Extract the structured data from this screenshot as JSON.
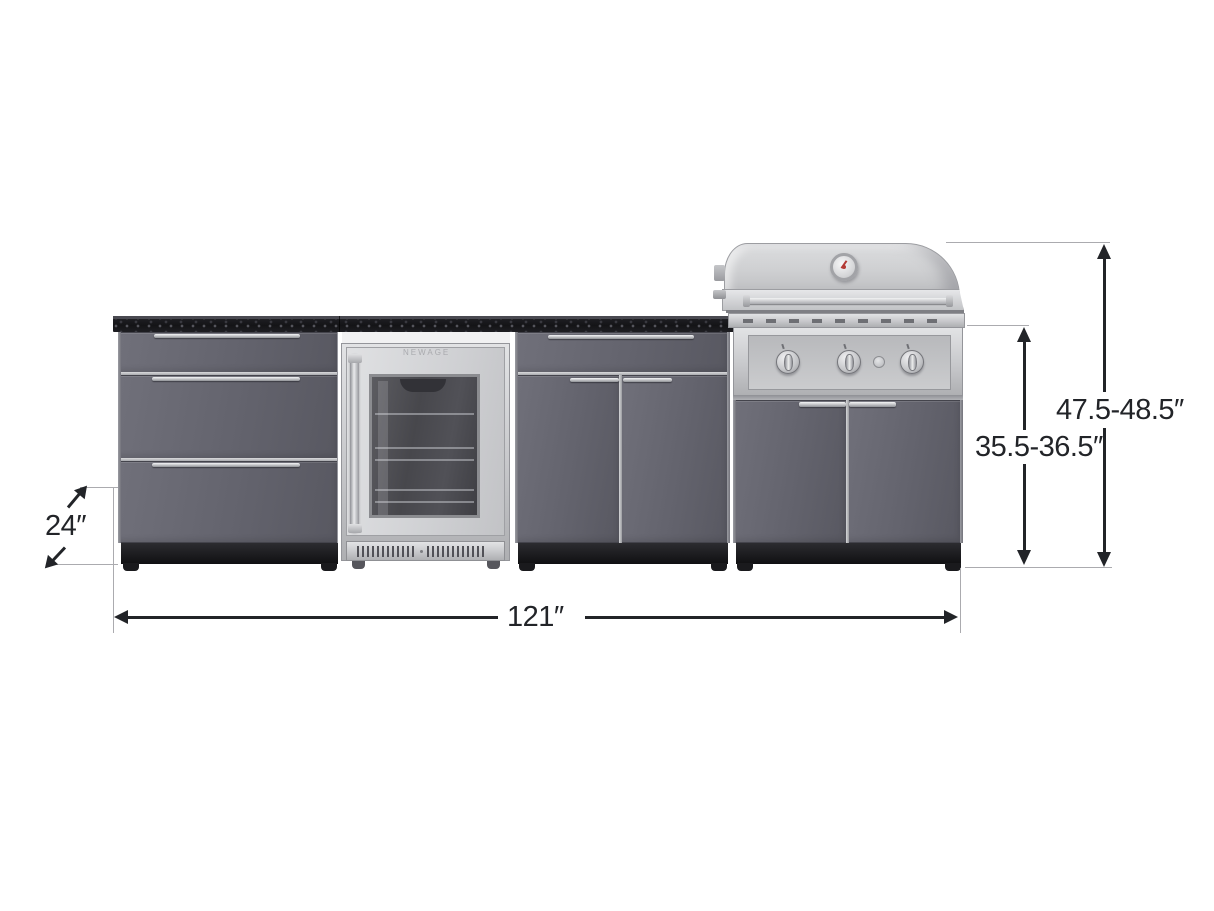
{
  "diagram": {
    "type": "product-dimension-diagram",
    "subject": "Outdoor kitchen cabinet set: 3-drawer cabinet, glass-door beverage fridge, 2-door cabinet, and grill cabinet with stainless hood",
    "background_color": "#ffffff"
  },
  "annotations": {
    "depth": "24″",
    "overall_width": "121″",
    "counter_height": "35.5-36.5″",
    "overall_height": "47.5-48.5″"
  },
  "branding": {
    "fridge_logo": "NEWAGE"
  },
  "palette": {
    "cabinet_gray": "#63636d",
    "countertop_black": "#17171a",
    "stainless_steel": "#c7c8cb",
    "plinth_black": "#19191c",
    "dimension_ink": "#222428",
    "extension_line_gray": "#ababaf",
    "thermometer_accent": "#b33a35"
  }
}
